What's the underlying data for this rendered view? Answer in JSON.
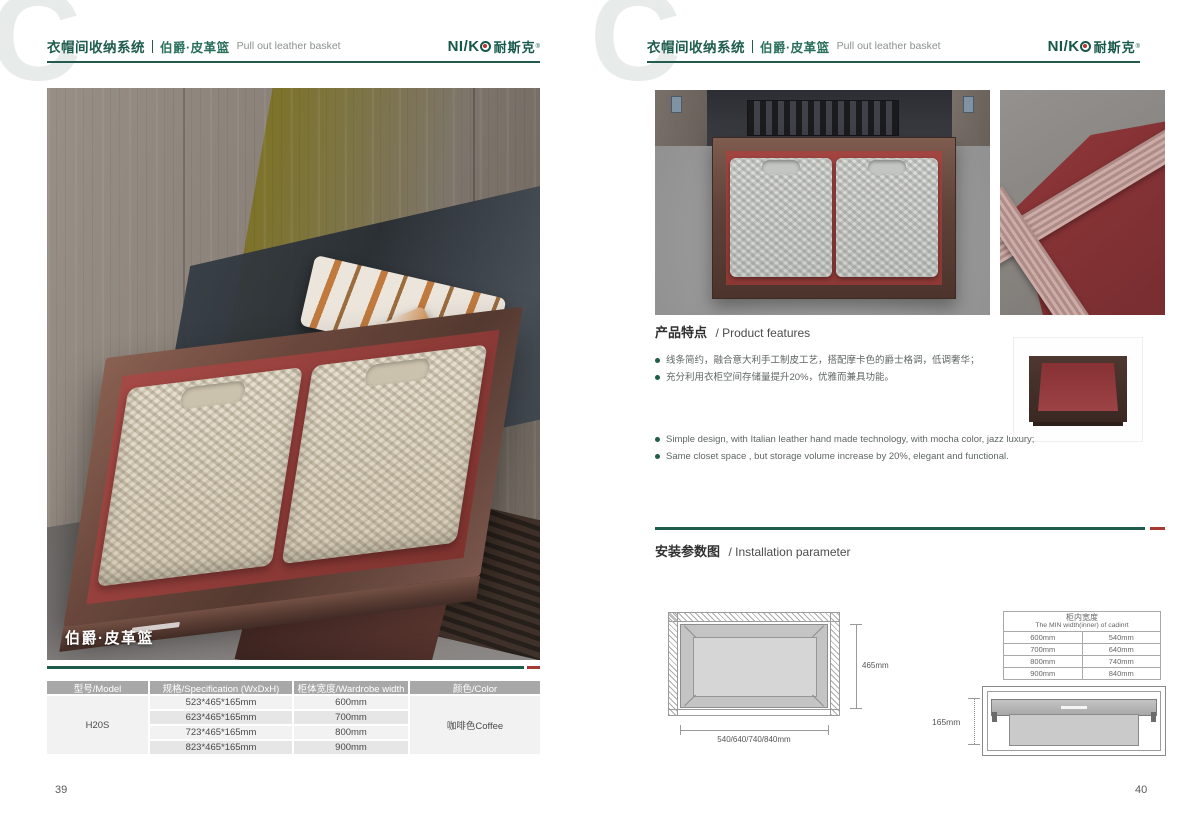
{
  "brand": {
    "watermark": "C",
    "logo_left": "NI/K",
    "logo_cn": "耐斯克",
    "registered": "®"
  },
  "header": {
    "title_cn": "衣帽间收纳系统",
    "subtitle_cn": "伯爵·皮革篮",
    "subtitle_en": "Pull out leather basket"
  },
  "accent_colors": {
    "brand_green": "#1e5c4c",
    "accent_red": "#a83a33",
    "leather_red": "#9a403c",
    "frame_brown": "#5f4238",
    "table_header_gray": "#a8a8a8"
  },
  "left_page": {
    "page_number": "39",
    "photo_caption": "伯爵·皮革篮",
    "spec_table": {
      "headers": [
        "型号/Model",
        "规格/Specification (WxDxH)",
        "柜体宽度/Wardrobe width",
        "颜色/Color"
      ],
      "model": "H20S",
      "color": "咖啡色Coffee",
      "rows": [
        {
          "spec": "523*465*165mm",
          "width": "600mm"
        },
        {
          "spec": "623*465*165mm",
          "width": "700mm"
        },
        {
          "spec": "723*465*165mm",
          "width": "800mm"
        },
        {
          "spec": "823*465*165mm",
          "width": "900mm"
        }
      ]
    }
  },
  "right_page": {
    "page_number": "40",
    "features": {
      "heading_cn": "产品特点",
      "heading_en": "/ Product features",
      "bullets_cn": [
        "线条简约，融合意大利手工制皮工艺，搭配摩卡色的爵士格调，低调奢华；",
        "充分利用衣柜空间存储量提升20%，优雅而兼具功能。"
      ],
      "bullets_en": [
        "Simple design, with Italian leather hand made technology, with mocha color, jazz luxury;",
        "Same closet space , but storage volume increase by 20%, elegant and functional."
      ]
    },
    "installation": {
      "heading_cn": "安装参数图",
      "heading_en": "/ Installation parameter",
      "top_view": {
        "depth_label": "465mm",
        "width_label": "540/640/740/840mm"
      },
      "width_table": {
        "title_cn": "柜内宽度",
        "title_en": "The MIN width(inner) of cadinrt",
        "rows": [
          [
            "600mm",
            "540mm"
          ],
          [
            "700mm",
            "640mm"
          ],
          [
            "800mm",
            "740mm"
          ],
          [
            "900mm",
            "840mm"
          ]
        ]
      },
      "side_view": {
        "height_label": "165mm"
      }
    }
  }
}
